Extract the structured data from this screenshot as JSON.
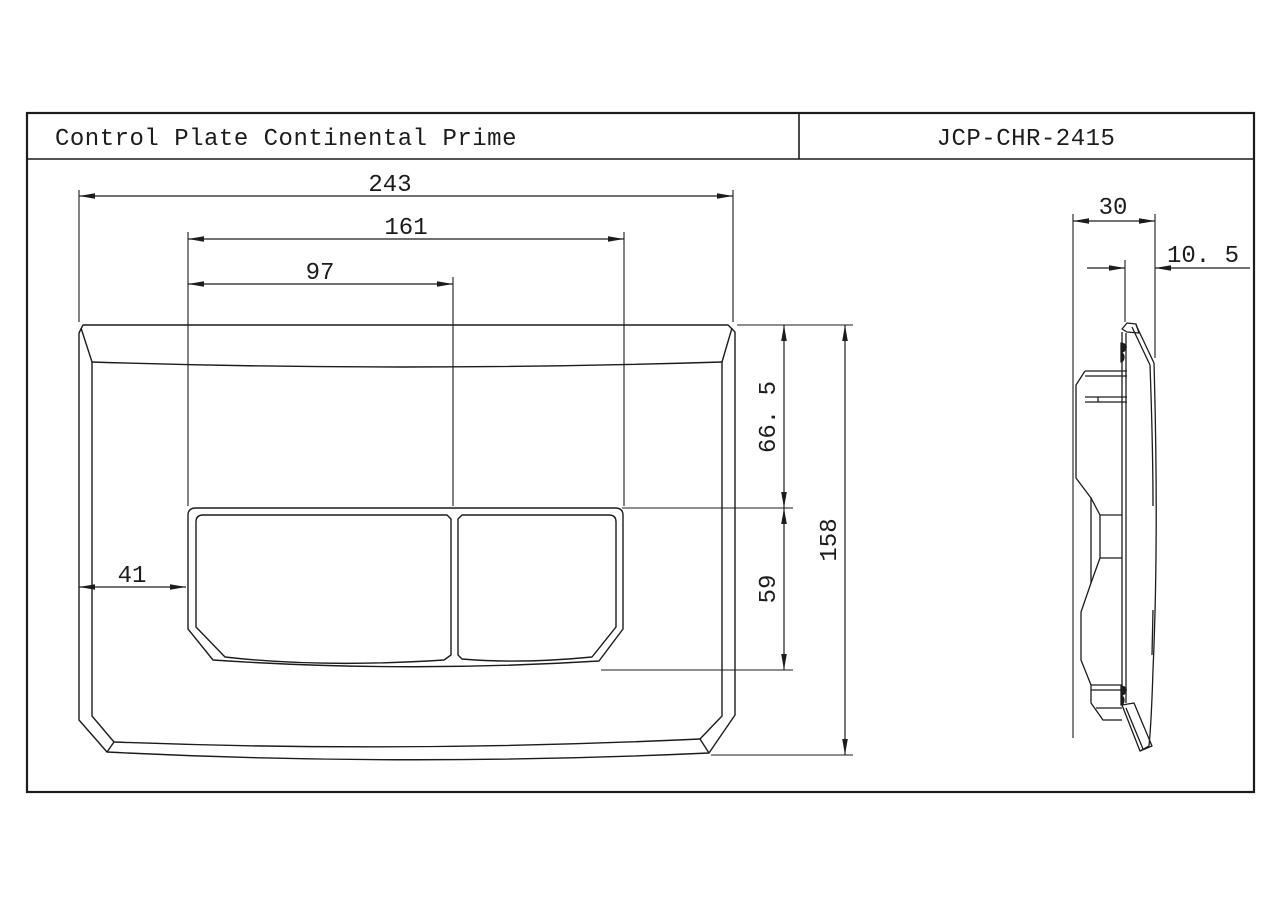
{
  "title_block": {
    "product_name": "Control Plate Continental Prime",
    "part_number": "JCP-CHR-2415"
  },
  "front_view": {
    "dimensions": {
      "overall_width": "243",
      "button_span_width": "161",
      "left_button_width": "97",
      "left_edge_to_buttons": "41",
      "top_to_buttons_height": "66. 5",
      "buttons_height": "59",
      "overall_height": "158"
    }
  },
  "side_view": {
    "dimensions": {
      "depth": "30",
      "plate_protrusion": "10. 5"
    }
  }
}
